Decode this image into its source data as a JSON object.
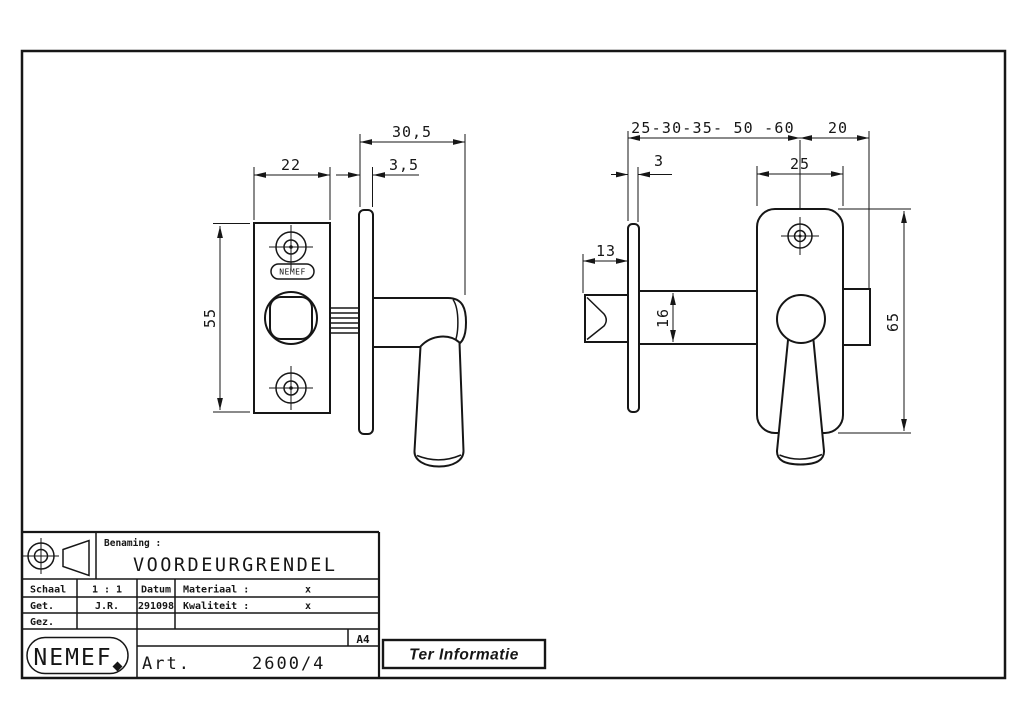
{
  "drawing": {
    "frame_color": "#161616",
    "left_view": {
      "dim_depth": "30,5",
      "dim_plate_width": "22",
      "dim_faceplate": "3,5",
      "dim_height": "55",
      "plate_logo": "NEMEF"
    },
    "right_view": {
      "dim_backsets": "25-30-35- 50 -60",
      "dim_tail": "20",
      "dim_faceplate": "3",
      "dim_body_width": "25",
      "dim_bolt_throw": "13",
      "dim_bolt_dia": "16",
      "dim_body_height": "65"
    }
  },
  "title_block": {
    "benaming_label": "Benaming :",
    "benaming_value": "VOORDEURGRENDEL",
    "schaal_label": "Schaal",
    "schaal_value": "1 : 1",
    "datum_label": "Datum",
    "datum_value": "291098",
    "materiaal_label": "Materiaal :",
    "materiaal_value": "x",
    "kwaliteit_label": "Kwaliteit :",
    "kwaliteit_value": "x",
    "get_label": "Get.",
    "get_value": "J.R.",
    "gez_label": "Gez.",
    "format": "A4",
    "brand": "NEMEF",
    "art_label": "Art.",
    "art_number": "2600/4"
  },
  "stamp": {
    "text": "Ter Informatie"
  }
}
